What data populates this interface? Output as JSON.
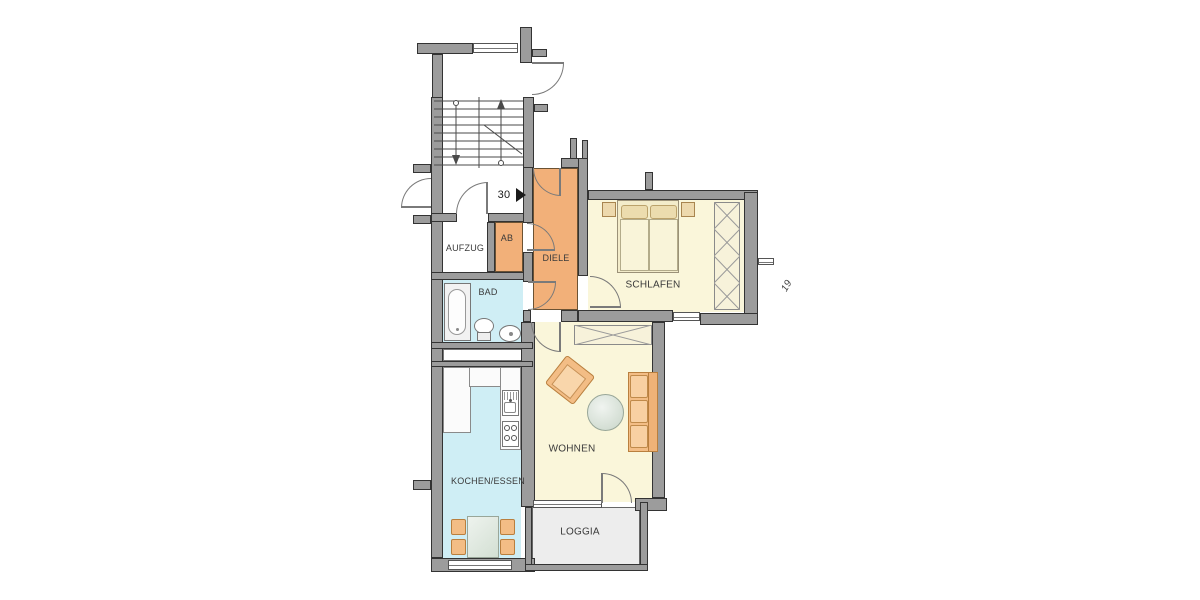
{
  "plan": {
    "rooms": {
      "aufzug": {
        "label": "AUFZUG"
      },
      "ab": {
        "label": "AB"
      },
      "diele": {
        "label": "DIELE"
      },
      "bad": {
        "label": "BAD"
      },
      "schlafen": {
        "label": "SCHLAFEN"
      },
      "wohnen": {
        "label": "WOHNEN"
      },
      "kochen_essen": {
        "label": "KOCHEN/ESSEN"
      },
      "loggia": {
        "label": "LOGGIA"
      }
    },
    "units": {
      "current": "30",
      "neighbor": "19"
    },
    "colors": {
      "wall": "#9c9c9c",
      "wall_edge": "#333333",
      "hall_orange": "#f2b079",
      "room_yellow": "#faf6da",
      "room_blue": "#cfeef5",
      "loggia_grey": "#ededed",
      "furniture_orange": "#f3bd85",
      "furniture_border": "#b97f3e",
      "door_stroke": "#7a7a7a"
    }
  }
}
